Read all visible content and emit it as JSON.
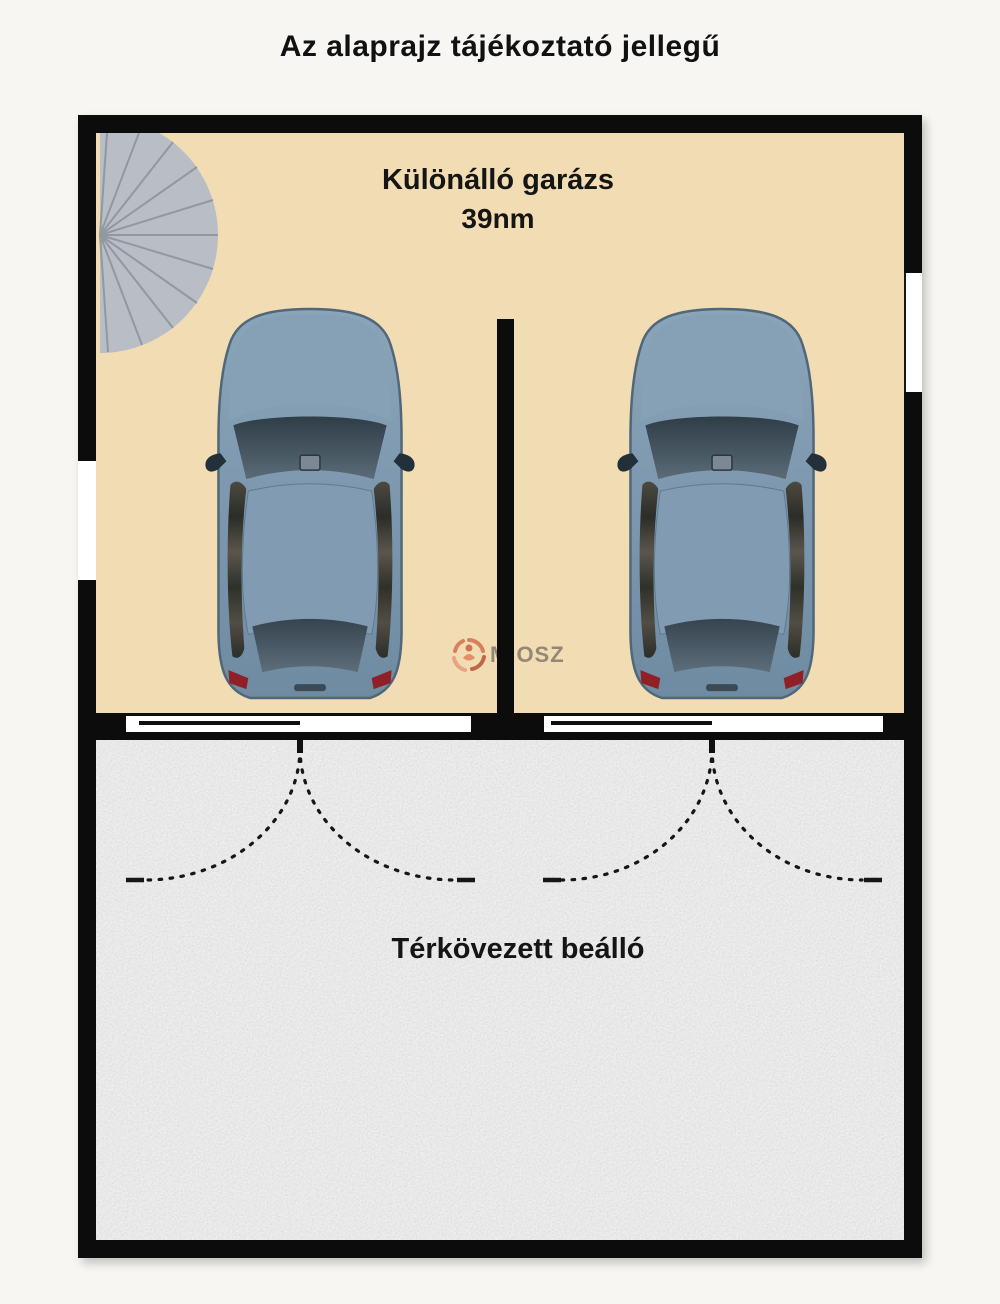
{
  "title": "Az alaprajz tájékoztató jellegű",
  "garage": {
    "name": "Különálló garázs",
    "area": "39nm"
  },
  "carport": {
    "name": "Térkövezett beálló"
  },
  "watermark": {
    "text": "MIOSZ"
  },
  "icons": {
    "car": "car-top-view-icon",
    "stairs": "spiral-staircase-icon",
    "door_swing": "door-swing-arc-icon",
    "logo": "miosz-logo-icon"
  },
  "colors": {
    "background": "#f7f6f2",
    "title_color": "#111111",
    "wall": "#0c0c0c",
    "garage_floor": "#f2dcb3",
    "paving": "#c7c7c7",
    "car_body": "#7d98ae",
    "car_glass": "#3c4a55",
    "stairs": "#b9bdc5",
    "stairs_line": "#9298a1",
    "taillight": "#8e2026",
    "watermark_accent": "#d4714f",
    "watermark_text": "#84796b"
  }
}
